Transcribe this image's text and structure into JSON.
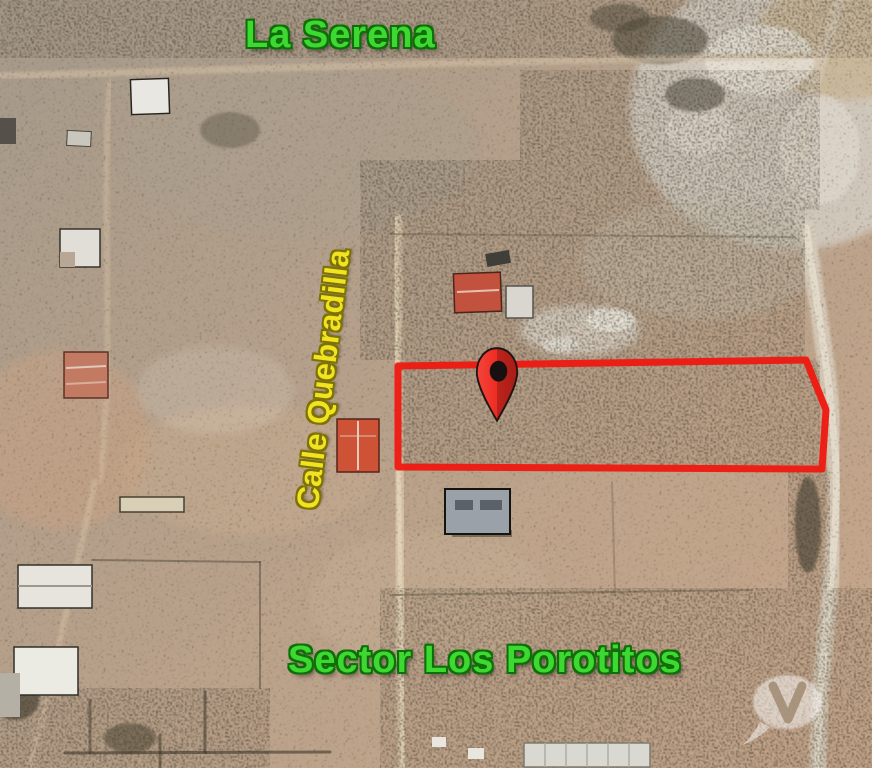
{
  "map": {
    "place_labels": {
      "region": {
        "text": "La Serena",
        "color": "#3ed832",
        "outline": "#0f6e08"
      },
      "street": {
        "text": "Calle Quebradilla",
        "color": "#f2e320",
        "outline": "#7c7208",
        "rotation_deg": -83
      },
      "sector": {
        "text": "Sector Los Porotitos",
        "color": "#3ed832",
        "outline": "#0f6e08"
      }
    },
    "parcel": {
      "outline_color": "#ee1a12",
      "shape": "irregular rectangle lot boundary"
    },
    "marker": {
      "type": "red-map-pin",
      "fill": "#ee2c22",
      "hole_color": "#171010"
    },
    "watermarks": {
      "center": "faint translucent logo (illegible)",
      "corner": "translucent speech-bubble V logo"
    },
    "imagery": "satellite aerial view of desert lots and dirt roads"
  }
}
